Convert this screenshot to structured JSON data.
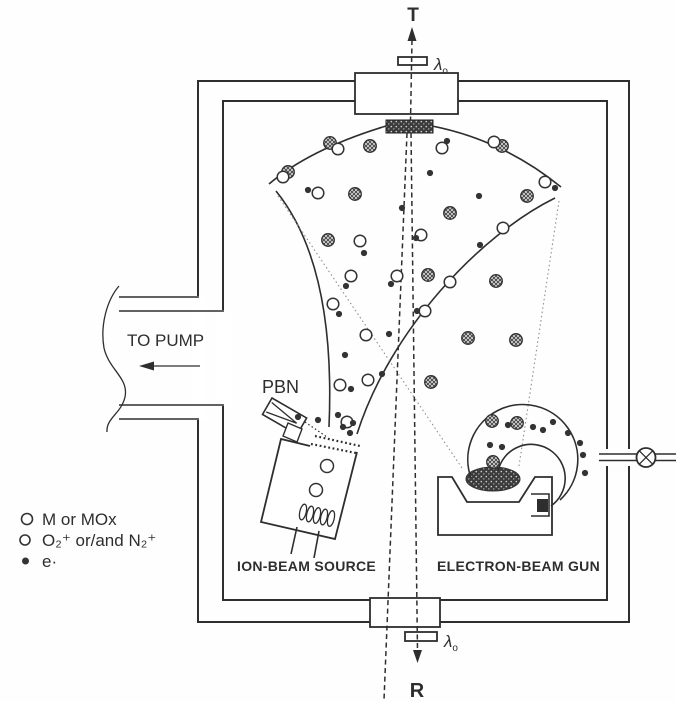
{
  "figure": {
    "labels": {
      "top_axis": "T",
      "bottom_axis": "R",
      "lambda_main": "λ",
      "lambda_sub": "o",
      "to_pump": "TO PUMP",
      "pbn": "PBN",
      "ion_source": "ION-BEAM SOURCE",
      "egun": "ELECTRON-BEAM GUN"
    },
    "legend": {
      "items": [
        {
          "symbol": "open-circle-large",
          "label": "M or MOx"
        },
        {
          "symbol": "open-circle-small",
          "label": "O₂⁺ or/and  N₂⁺"
        },
        {
          "symbol": "filled-dot",
          "label": "e·"
        }
      ]
    },
    "colors": {
      "ink": "#2e2e2e",
      "faint_guide": "#8f8f8f",
      "paper": "#ffffff",
      "hatch_fill": "#dedede",
      "stipple_dark": "#3b3b3b"
    },
    "particles": {
      "molecules": [
        [
          330,
          143
        ],
        [
          370,
          146
        ],
        [
          288,
          172
        ],
        [
          355,
          194
        ],
        [
          450,
          213
        ],
        [
          328,
          240
        ],
        [
          428,
          275
        ],
        [
          496,
          281
        ],
        [
          527,
          196
        ],
        [
          468,
          338
        ],
        [
          516,
          340
        ],
        [
          431,
          382
        ],
        [
          502,
          146
        ],
        [
          492,
          421
        ],
        [
          517,
          423
        ],
        [
          493,
          462
        ]
      ],
      "ions": [
        [
          338,
          149
        ],
        [
          283,
          177
        ],
        [
          442,
          148
        ],
        [
          318,
          193
        ],
        [
          360,
          241
        ],
        [
          397,
          276
        ],
        [
          351,
          276
        ],
        [
          333,
          304
        ],
        [
          421,
          235
        ],
        [
          425,
          311
        ],
        [
          450,
          282
        ],
        [
          503,
          228
        ],
        [
          545,
          182
        ],
        [
          494,
          142
        ],
        [
          366,
          335
        ],
        [
          368,
          380
        ],
        [
          340,
          385
        ],
        [
          347,
          422
        ]
      ],
      "electrons": [
        [
          447,
          141
        ],
        [
          430,
          173
        ],
        [
          402,
          208
        ],
        [
          416,
          238
        ],
        [
          308,
          190
        ],
        [
          364,
          253
        ],
        [
          346,
          286
        ],
        [
          391,
          284
        ],
        [
          339,
          314
        ],
        [
          417,
          311
        ],
        [
          479,
          196
        ],
        [
          480,
          245
        ],
        [
          555,
          188
        ],
        [
          345,
          355
        ],
        [
          389,
          334
        ],
        [
          382,
          374
        ],
        [
          351,
          389
        ],
        [
          338,
          415
        ],
        [
          353,
          423
        ],
        [
          343,
          427
        ],
        [
          350,
          433
        ],
        [
          298,
          417
        ],
        [
          318,
          420
        ],
        [
          508,
          425
        ],
        [
          533,
          427
        ],
        [
          543,
          430
        ],
        [
          553,
          422
        ],
        [
          568,
          433
        ],
        [
          580,
          443
        ],
        [
          583,
          455
        ],
        [
          490,
          445
        ],
        [
          502,
          447
        ],
        [
          585,
          473
        ]
      ]
    }
  }
}
